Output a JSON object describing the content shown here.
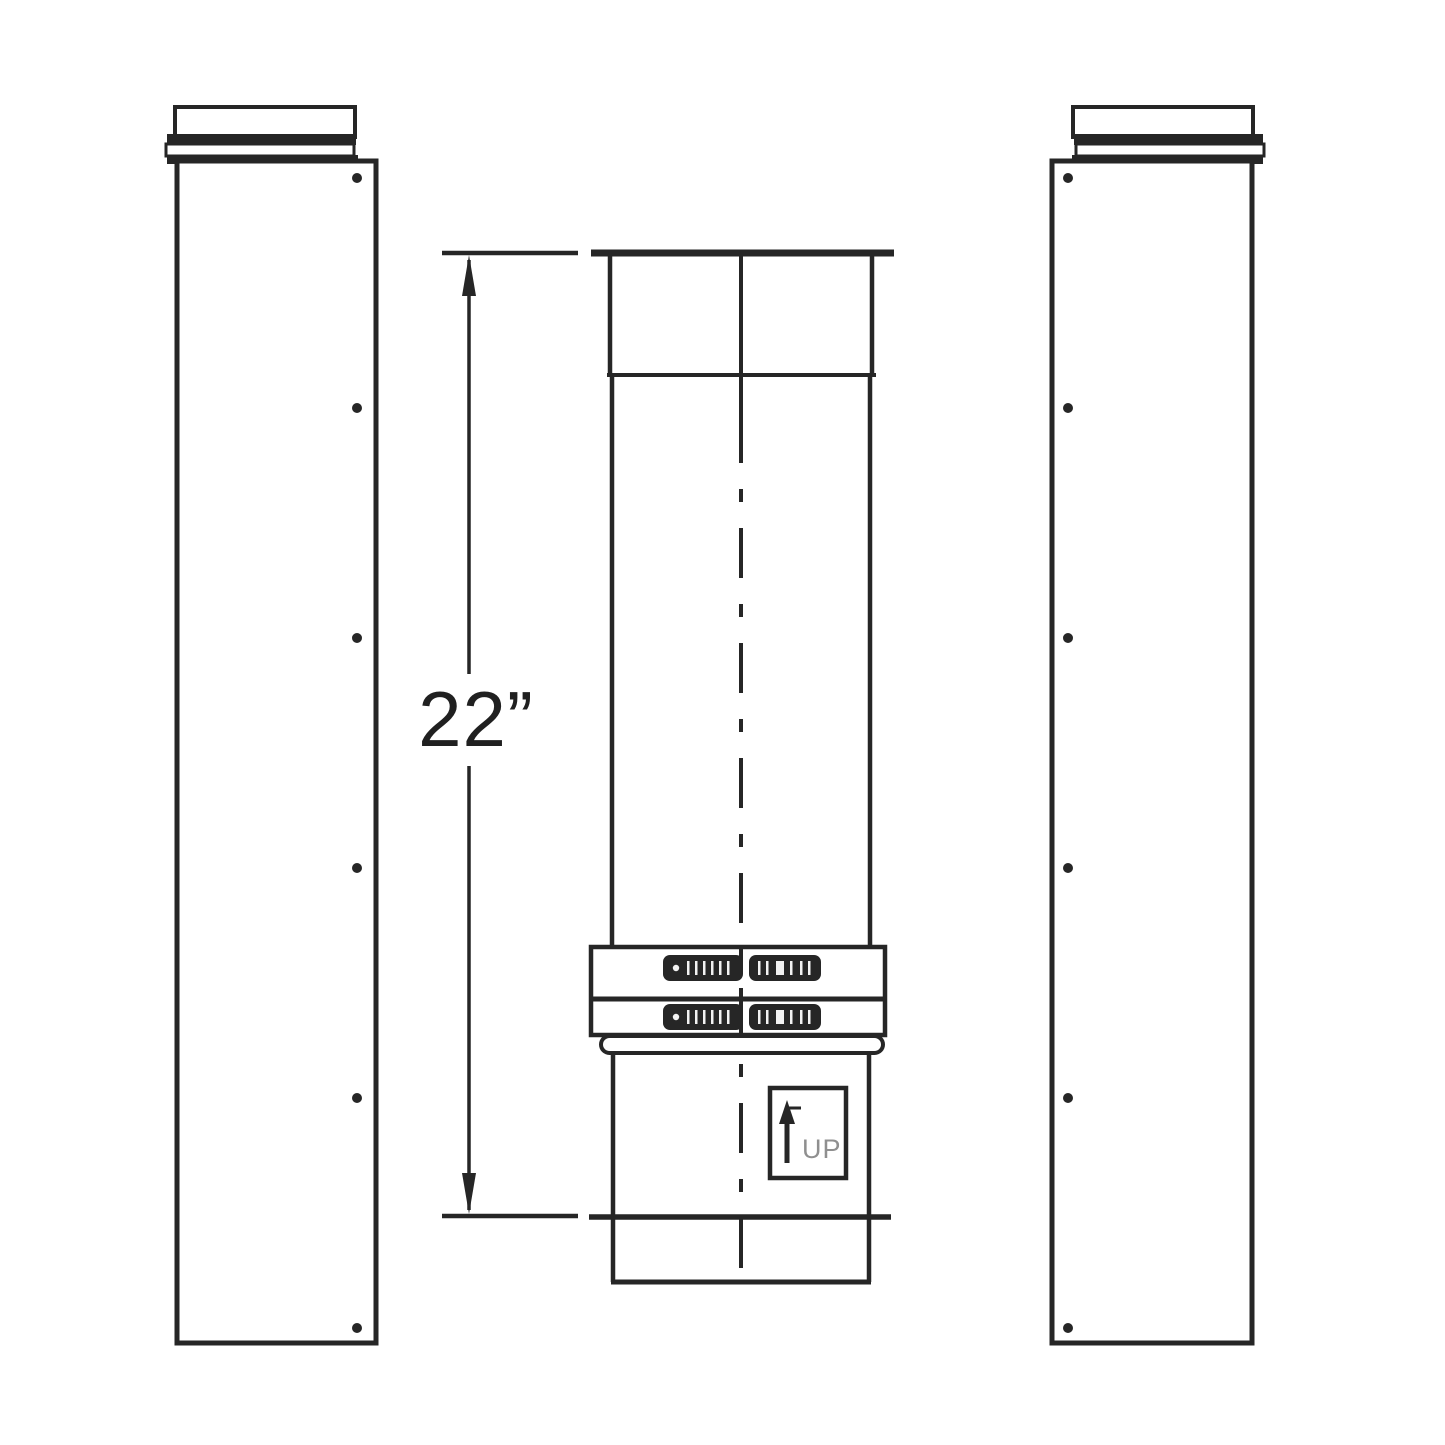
{
  "colors": {
    "ink": "#262626",
    "background": "#ffffff",
    "up_label_text": "#8f8f8f"
  },
  "dimension": {
    "label": "22”"
  },
  "up_marker": {
    "label": "UP"
  }
}
